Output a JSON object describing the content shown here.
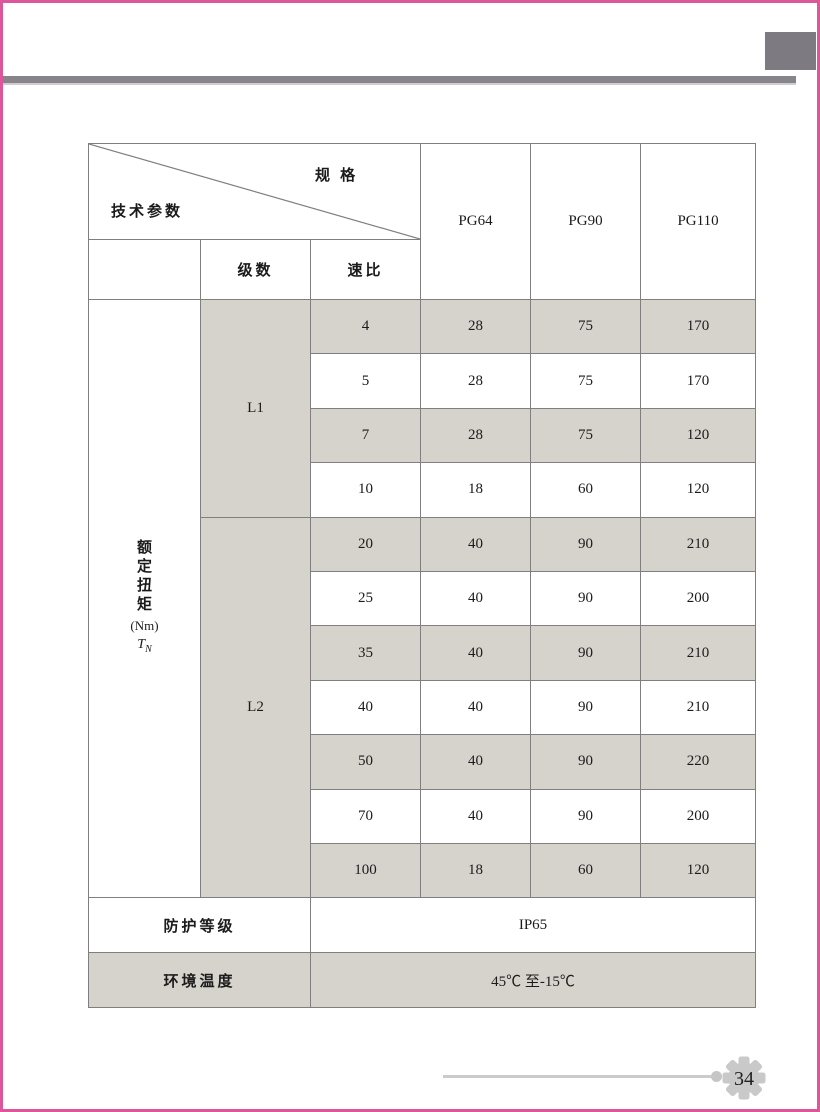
{
  "table": {
    "corner": {
      "spec_label": "规 格",
      "tech_label": "技术参数"
    },
    "spec_columns": [
      "PG64",
      "PG90",
      "PG110"
    ],
    "subheaders": {
      "stage": "级数",
      "ratio": "速比"
    },
    "torque_label": {
      "chars": [
        "额",
        "定",
        "扭",
        "矩"
      ],
      "unit": "(Nm)",
      "symbol": "T",
      "symbol_sub": "N"
    },
    "body": [
      {
        "stage": "L1",
        "ratio": "4",
        "values": [
          "28",
          "75",
          "170"
        ]
      },
      {
        "stage": "",
        "ratio": "5",
        "values": [
          "28",
          "75",
          "170"
        ]
      },
      {
        "stage": "",
        "ratio": "7",
        "values": [
          "28",
          "75",
          "120"
        ]
      },
      {
        "stage": "",
        "ratio": "10",
        "values": [
          "18",
          "60",
          "120"
        ]
      },
      {
        "stage": "L2",
        "ratio": "20",
        "values": [
          "40",
          "90",
          "210"
        ]
      },
      {
        "stage": "",
        "ratio": "25",
        "values": [
          "40",
          "90",
          "200"
        ]
      },
      {
        "stage": "",
        "ratio": "35",
        "values": [
          "40",
          "90",
          "210"
        ]
      },
      {
        "stage": "",
        "ratio": "40",
        "values": [
          "40",
          "90",
          "210"
        ]
      },
      {
        "stage": "",
        "ratio": "50",
        "values": [
          "40",
          "90",
          "220"
        ]
      },
      {
        "stage": "",
        "ratio": "70",
        "values": [
          "40",
          "90",
          "200"
        ]
      },
      {
        "stage": "",
        "ratio": "100",
        "values": [
          "18",
          "60",
          "120"
        ]
      }
    ],
    "protection": {
      "label": "防护等级",
      "value": "IP65"
    },
    "temperature": {
      "label": "环境温度",
      "value": "45℃ 至-15℃"
    }
  },
  "footer": {
    "page_number": "34"
  },
  "colors": {
    "accent_pink": "#dd569c",
    "bar_gray": "#87848b",
    "block_gray": "#7d7b81",
    "cell_shade": "#d6d3cd",
    "grid_line": "#7f7f7f",
    "footer_gray": "#c9c9c9"
  }
}
